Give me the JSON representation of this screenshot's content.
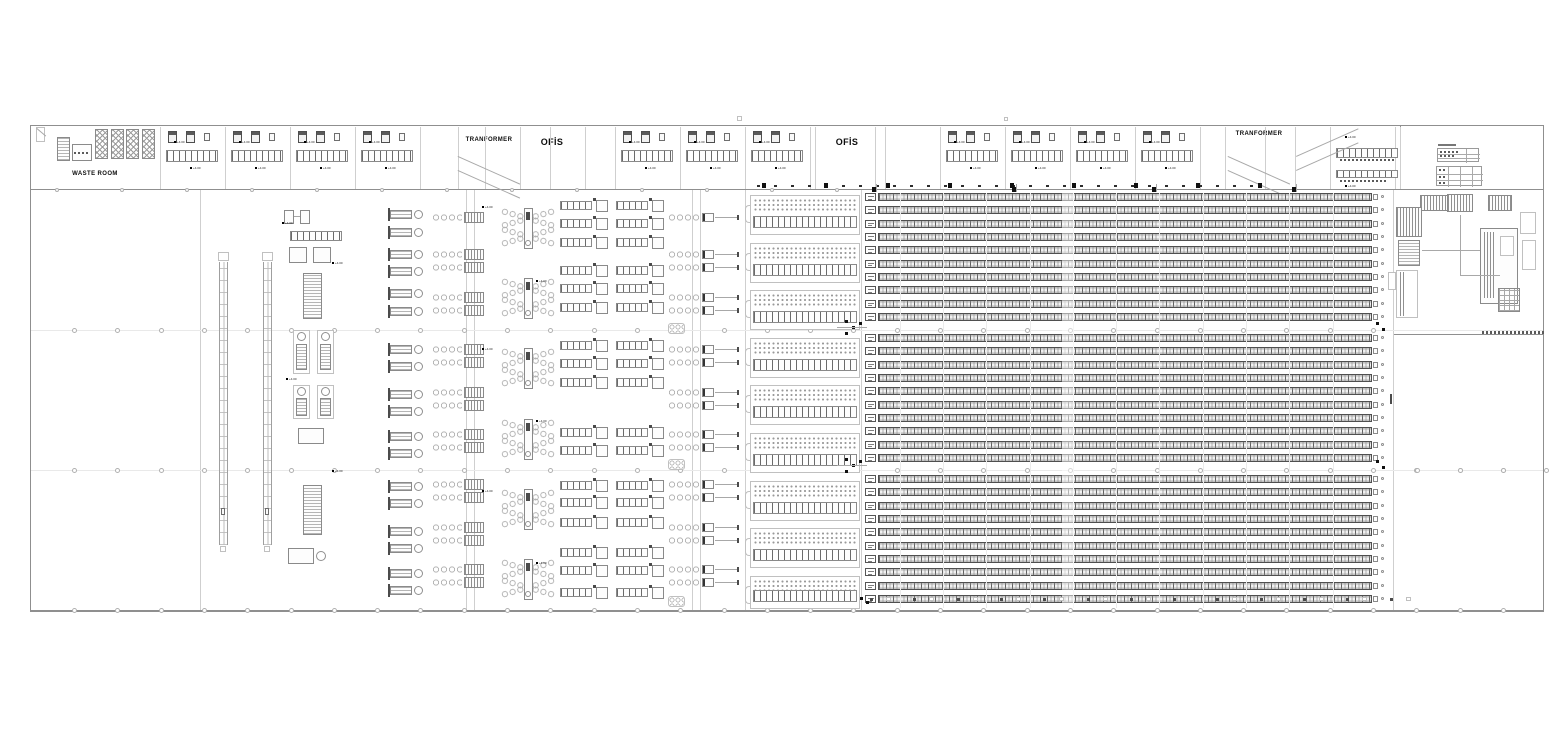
{
  "colors": {
    "paper": "#ffffff",
    "ink": "#2e2e2e",
    "wall": "#8f8f8f",
    "light_line": "#c9c9c9",
    "accent_dark": "#101010"
  },
  "labels": {
    "waste_room": "WASTE ROOM",
    "transformer_left": "TRANFORMER",
    "office_left": "OFİS",
    "office_right": "OFİS",
    "transformer_right": "TRANFORMER"
  },
  "annotations": {
    "elevation_mark": "+4.00"
  },
  "equipment_counts": {
    "long_machine_rows": 30,
    "roving_frames": 9,
    "card_rows": 17,
    "card_columns": 2,
    "feeder_rows": 18,
    "drawframe_rows": 17,
    "creel_clusters": 6,
    "conveyor_lines": 2,
    "small_symbol_boxes": 3
  }
}
